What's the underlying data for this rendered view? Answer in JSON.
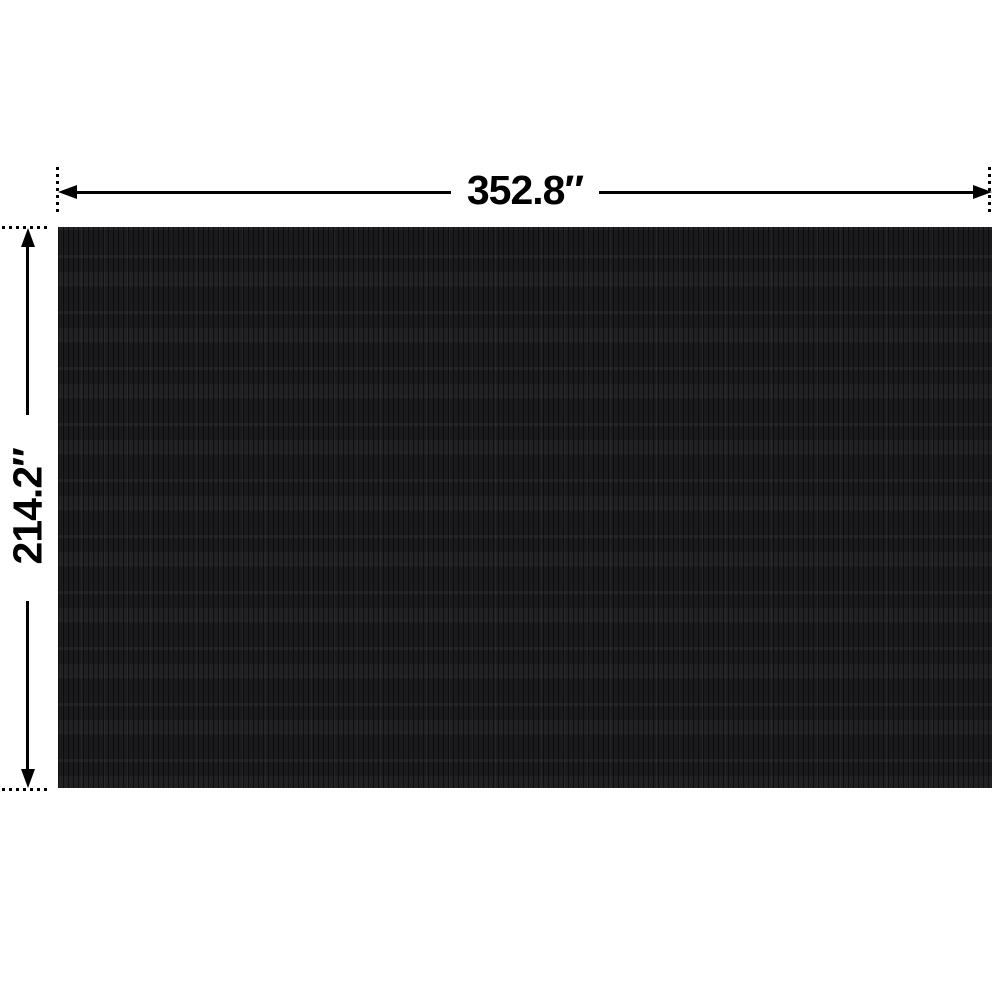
{
  "diagram": {
    "description": "product dimension diagram of a black textured rectangular cover",
    "width_label": "352.8″",
    "height_label": "214.2″",
    "colors": {
      "background": "#ffffff",
      "product_fill": "#1a1a1c",
      "dimension_lines": "#000000",
      "label_text": "#000000"
    },
    "icons": {
      "arrow_left": "arrow-left-icon",
      "arrow_right": "arrow-right-icon",
      "arrow_up": "arrow-up-icon",
      "arrow_down": "arrow-down-icon"
    }
  }
}
